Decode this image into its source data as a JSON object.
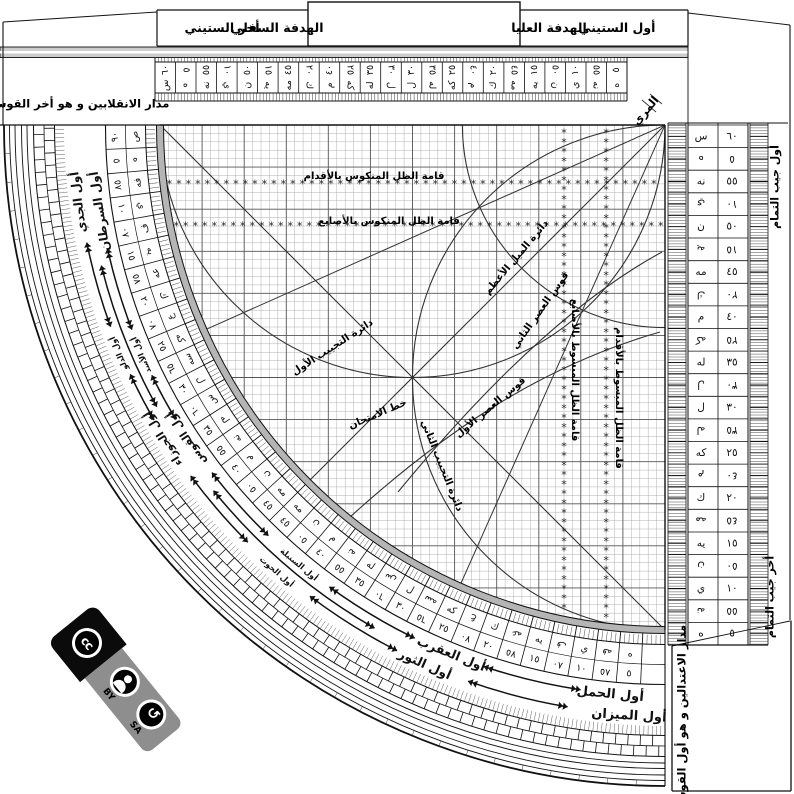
{
  "instrument": {
    "tabs": {
      "end_sixty": "أخر الستيني",
      "lower_sight": "الهدفة السفلي",
      "upper_sight": "الهدفة العليا",
      "start_sixty": "أول الستيني"
    },
    "sight_index": "المري",
    "solstice_label": "مدار الانقلابين و هو أخر القوس",
    "equinox_label": "مدار الاعتدالين و هو أول القوس",
    "cosine_start": "أول جيب التمام",
    "cosine_end": "أخر جيب التمام"
  },
  "grid_labels": {
    "inverse_shadow_feet": "قامة الظل المنكوس بالأقدام",
    "inverse_shadow_digits": "قامة الظل المنكوس بالأصابع",
    "plane_shadow_feet": "قامة الظل المبسوط بالأقدام",
    "plane_shadow_digits": "قامة الظل المبسوط بالأصابع",
    "max_declination": "دائرة الميل الأعظم",
    "second_asr": "قوس العصر الثاني",
    "first_asr": "قوس العصر الأول",
    "first_sine_circle": "دائرة التجييب الأول",
    "second_sine_circle": "دائرة التجييب الثاني",
    "test_line": "خط الامتحان"
  },
  "zodiac": {
    "capricorn": "أول الجدي",
    "cancer": "أول السرطان",
    "aquarius": "أول الدلو",
    "leo": "أول الأسد",
    "gemini": "أول الجوزاء",
    "sagittarius": "أول القوس",
    "pisces": "أول الحوت",
    "virgo": "أول السنبلة",
    "taurus": "أول الثور",
    "scorpio": "أول العقرب",
    "aries": "أول الحمل",
    "libra": "أول الميزان"
  },
  "scales": {
    "sexagesimal": [
      {
        "n": "٦٠",
        "a": "س"
      },
      {
        "n": "٥٥",
        "a": "نه"
      },
      {
        "n": "٥٠",
        "a": "ن"
      },
      {
        "n": "٤٥",
        "a": "مه"
      },
      {
        "n": "٤٠",
        "a": "م"
      },
      {
        "n": "٣٥",
        "a": "له"
      },
      {
        "n": "٣٠",
        "a": "ل"
      },
      {
        "n": "٢٥",
        "a": "كه"
      },
      {
        "n": "٢٠",
        "a": "ك"
      },
      {
        "n": "١٥",
        "a": "يه"
      },
      {
        "n": "١٠",
        "a": "ي"
      },
      {
        "n": "٥",
        "a": "ه"
      }
    ],
    "arc_extension": [
      {
        "n": "٩٠",
        "a": "ص"
      },
      {
        "n": "٨٥",
        "a": "فه"
      },
      {
        "n": "٨٠",
        "a": "ف"
      },
      {
        "n": "٧٥",
        "a": "عه"
      },
      {
        "n": "٧٠",
        "a": "ع"
      },
      {
        "n": "٦٥",
        "a": "سه"
      }
    ]
  },
  "license": {
    "cc": "cc",
    "by": "BY",
    "sa": "SA",
    "sa_icon": "↺"
  },
  "colors": {
    "ink": "#111111",
    "mid": "#333333",
    "grid_light": "#a8a8a8",
    "grid_bold": "#555555",
    "band_gray": "#b5b5b5",
    "stripe_gray": "#cccccc",
    "badge_gray": "#8e8e8e"
  }
}
